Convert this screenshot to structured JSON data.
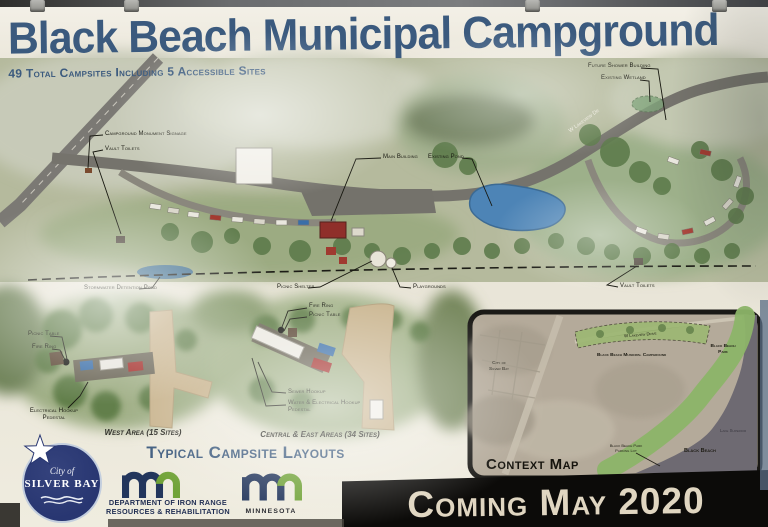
{
  "header": {
    "title": "Black Beach Municipal Campground",
    "subtitle": "49 Total Campsites Including 5 Accessible Sites"
  },
  "site_plan": {
    "monument_label": "Campground Monument Signage",
    "vault_toilets_west_label": "Vault Toilets",
    "main_building_label": "Main Building",
    "existing_pond_label": "Existing Pond",
    "future_shower_label": "Future Shower Building",
    "existing_wetland_label": "Existing Wetland",
    "stormwater_label": "Stormwater Detention Pond",
    "picnic_shelter_label": "Picnic Shelter",
    "playgrounds_label": "Playgrounds",
    "vault_toilets_east_label": "Vault Toilets",
    "road_label": "W Lakeview Dr"
  },
  "campsite_layouts": {
    "heading": "Typical Campsite Layouts",
    "west": {
      "picnic_table_label": "Picnic Table",
      "fire_ring_label": "Fire Ring",
      "electrical_label_line1": "Electrical Hookup",
      "electrical_label_line2": "Pedestal",
      "caption": "West Area (15 Sites)"
    },
    "central": {
      "fire_ring_label": "Fire Ring",
      "picnic_table_label": "Picnic Table",
      "sewer_label": "Sewer Hookup",
      "water_electrical_line1": "Water & Electrical Hookup",
      "water_electrical_line2": "Pedestal",
      "caption": "Central & East Areas (34 Sites)"
    }
  },
  "context_map": {
    "title": "Context Map",
    "campground_label": "Black Beach Municipal Campground",
    "city_label_line1": "City of",
    "city_label_line2": "Silver Bay",
    "park_label_line1": "Black Beach",
    "park_label_line2": "Park",
    "beach_label": "Black Beach",
    "lake_label": "Lake Superior",
    "parking_label_line1": "Black Beach Park",
    "parking_label_line2": "Parking Lot",
    "road_label": "W Lakeview Drive"
  },
  "footer": {
    "city_logo_line1": "City of",
    "city_logo_line2": "SILVER BAY",
    "dept_line1": "DEPARTMENT OF IRON RANGE",
    "dept_line2": "RESOURCES & REHABILITATION",
    "minnesota_label": "MINNESOTA",
    "banner": "Coming May 2020"
  },
  "colors": {
    "title_blue": "#3b5a7e",
    "map_green": "#b5ba9d",
    "pond_blue": "#4d84b6",
    "banner_black": "#0c0b09",
    "banner_text": "#e0d6c1",
    "logo_navy": "#283671",
    "mn_navy": "#23365c",
    "mn_green": "#71a338"
  }
}
